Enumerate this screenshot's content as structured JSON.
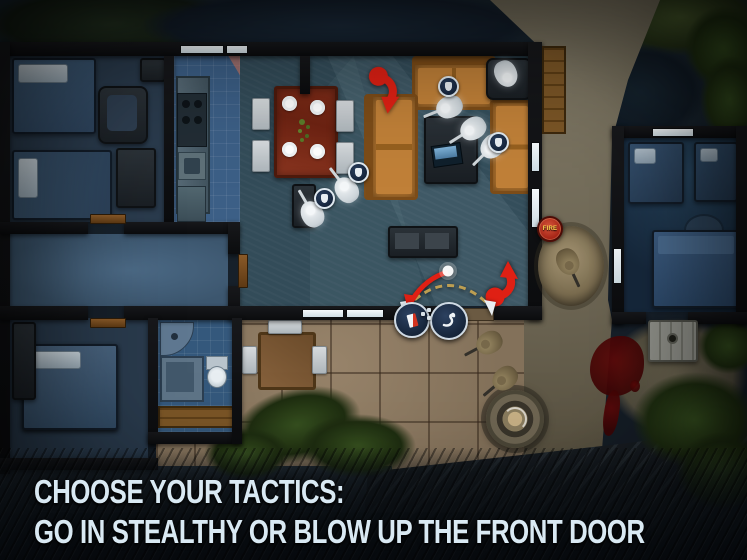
{
  "caption": {
    "line1": "CHOOSE YOUR TACTICS:",
    "line2": "GO IN STEALTHY OR BLOW UP THE FRONT DOOR"
  },
  "hud": {
    "fire_badge_label": "FIRE"
  },
  "icons": {
    "waypoint_breach": "breach-door-waypoint-icon",
    "waypoint_move": "sneak-move-waypoint-icon",
    "fire_alarm": "fire-alarm-badge",
    "threat_marker": "threat-direction-arrow",
    "door_swing": "door-swing-arc"
  },
  "map_entities": {
    "swat_operators": 5,
    "enemy_guards": 3,
    "rooms": [
      "bedroom-top-left",
      "kitchen",
      "living-dining-room",
      "hallway",
      "bedroom-bottom-left",
      "bathroom",
      "guest-house"
    ],
    "outdoor_props": [
      "dirt-path",
      "patio",
      "garden-table",
      "well",
      "cellar-hatch",
      "guard-pit",
      "blood-pool",
      "bushes",
      "wood-deck"
    ]
  },
  "colors": {
    "threat_red": "#df2014",
    "arc_gold": "#c9a653",
    "fire_badge": "#a32114",
    "caption_text": "#d9e9f3",
    "swat_unit": "#f2f5f7",
    "enemy_unit": "#9c8c66",
    "couch_orange": "#b5762f",
    "table_wood": "#7e2c18"
  }
}
